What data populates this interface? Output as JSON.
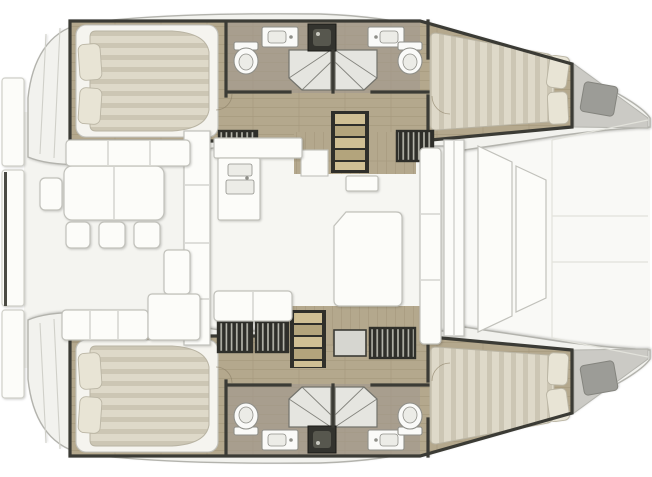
{
  "scene": {
    "type": "floor-plan",
    "subject": "catamaran-yacht-interior-layout",
    "orientation": "bow-right",
    "hulls": 2,
    "cabins": 4,
    "bathrooms": 4
  },
  "fixture_types": [
    "double-bed",
    "pillow",
    "toilet",
    "washbasin",
    "shower",
    "companionway-stairs",
    "center-staircase",
    "dining-table",
    "chair",
    "bench-sofa",
    "galley-counter",
    "chart-table",
    "bow-locker",
    "stern-platform",
    "deck-hatch",
    "sliding-door"
  ],
  "colors": {
    "page_bg": "#ffffff",
    "deck_fill": "#f2f2ee",
    "deck_stroke": "#b3b3ad",
    "faint": "#d0d0c9",
    "cockpit_floor": "#f4f4f0",
    "salon_floor": "#f6f6f2",
    "foredeck": "#f9f9f6",
    "furniture": "#fcfcf9",
    "furniture_stroke": "#c1c1bb",
    "wall": "#3b3b35",
    "wood": "#b4a88d",
    "wood_grain": "#9a8d72",
    "bath_floor": "#a89e8e",
    "step_light": "#cfbf94",
    "step_dark": "#b3a47c",
    "slat_dark": "#2f2f2a",
    "slat_light": "#b9b9af",
    "mattress": "#ded9c9",
    "mattress_stripe": "#ccc6b4",
    "pillow": "#e8e4d5",
    "pillow_stroke": "#bab5a4",
    "bed_frame": "#f5f4ef",
    "fixture": "#fafaf8",
    "fixture_stroke": "#8f8f89",
    "shower": "#e5e5e0",
    "shower_line": "#73736c",
    "bow_locker": "#cbcac5",
    "bow_pad": "#9c9c97",
    "dark_fixture": "#33332e",
    "dark_fixture_inner": "#57574e",
    "davit": "#4a4a44"
  }
}
